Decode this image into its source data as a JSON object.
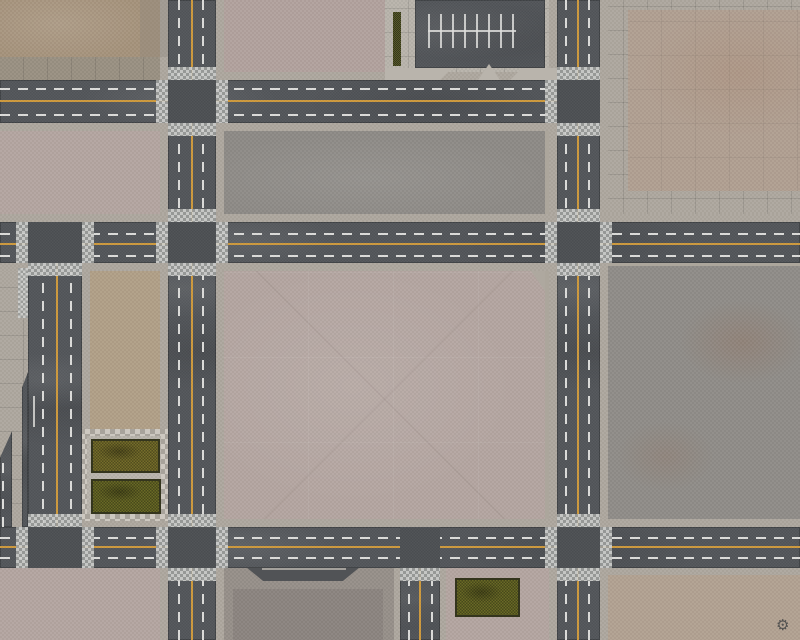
{
  "scene": {
    "title": "Top-down city streets battle mat",
    "logo_glyph": "⚙"
  },
  "colors": {
    "asphalt": "#53565a",
    "asphalt-dark": "#4d5054",
    "yellow-line": "#cf9a3d",
    "white-line": "#dddddb",
    "crosswalk-light": "#cfd0ce",
    "crosswalk-dark": "#9b9d9b",
    "sidewalk": "#aea89f",
    "sidewalk-band": "#9a9183",
    "plaza": "#b9b4ac",
    "block-tan-dark": "#a6937c",
    "block-tan": "#b1a092",
    "block-tan-mid": "#b1a088",
    "block-tan-low": "#b2a292",
    "block-pink": "#b4a6a1",
    "block-pink-light": "#b2a29e",
    "block-gray": "#8e8b87",
    "block-gray-cool": "#908d89",
    "grass-olive": "#6b6428",
    "grass-dark": "#5d5f23",
    "grass-border": "#34351d",
    "hedge": "#4c4f27",
    "pad-frame": "#97908a",
    "pad-inner": "#8c8580",
    "pad-notch": "#515356",
    "notch-line": "#b8b4ad",
    "white-mark": "#d8d8d5",
    "logo": "#3c3f41"
  },
  "features": {
    "horizontal_roads": 3,
    "vertical_roads": 4,
    "grass_patches": 3,
    "parking_lot": "double row of stalls, top center",
    "plaza_with_planters": "left center",
    "loading_pad": "bottom center",
    "crosswalks": "checkered bands at every intersection arm"
  }
}
